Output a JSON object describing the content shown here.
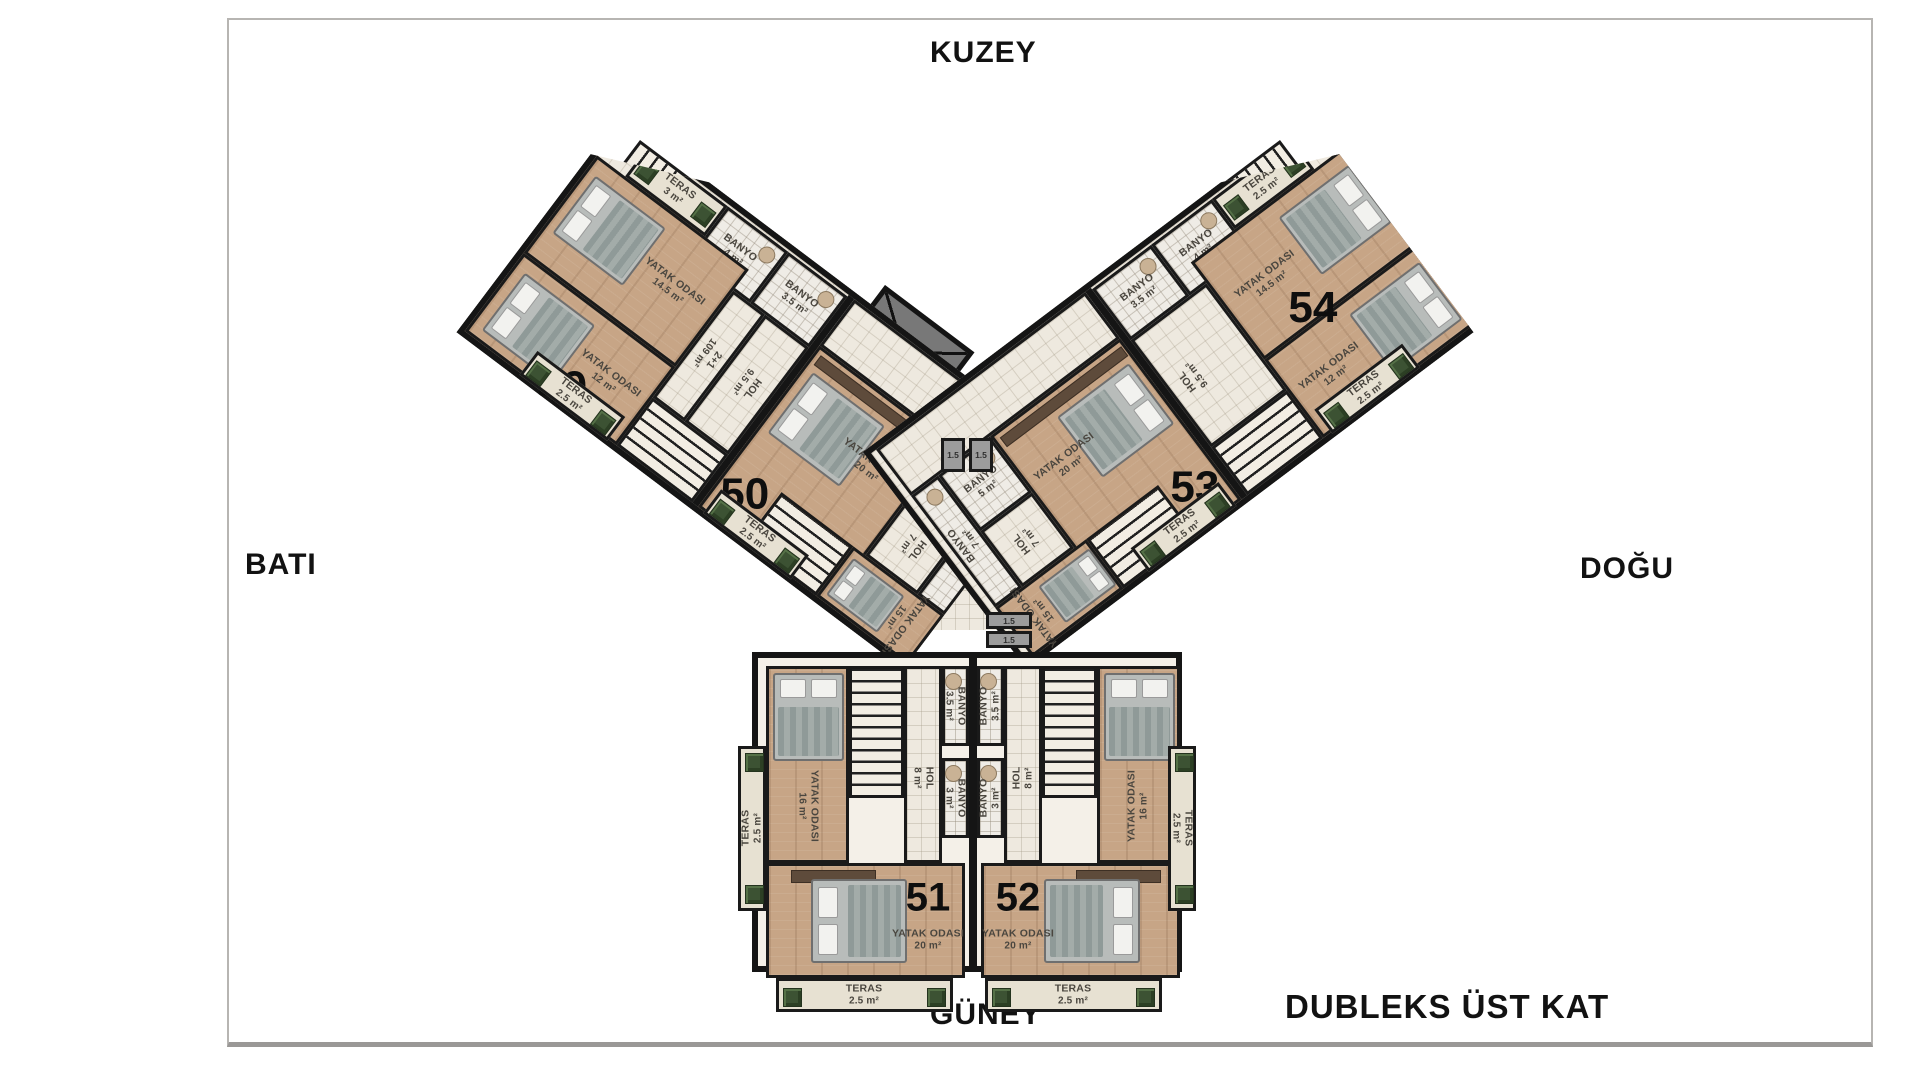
{
  "compass": {
    "north": "KUZEY",
    "south": "GÜNEY",
    "west": "BATI",
    "east": "DOĞU"
  },
  "floor_label": "DUBLEKS ÜST KAT",
  "core": {
    "shaft": "1.5",
    "stair_bath": "BANYO"
  },
  "colors": {
    "wall": "#1a1a1a",
    "wood": "#c7a586",
    "bath_tile": "#efece6",
    "terrace": "#e7e1d2",
    "plant": "#3c5233",
    "elevator": "#787878"
  },
  "units": {
    "u49": {
      "num": "49",
      "type": "2+1",
      "type_area": "109 m²",
      "bed1_n": "YATAK ODASI",
      "bed1_a": "14.5 m²",
      "bed2_n": "YATAK ODASI",
      "bed2_a": "12 m²",
      "bath1_n": "BANYO",
      "bath1_a": "4 m²",
      "bath2_n": "BANYO",
      "bath2_a": "3.5 m²",
      "hall_n": "HOL",
      "hall_a": "9.5 m²",
      "ter1_n": "TERAS",
      "ter1_a": "3 m²",
      "ter2_n": "TERAS",
      "ter2_a": "2.5 m²",
      "ter3_n": "TERAS",
      "ter3_a": "2.5 m²"
    },
    "u50": {
      "num": "50",
      "bed1_n": "YATAK ODASI",
      "bed1_a": "20 m²",
      "bed2_n": "YATAK ODASI",
      "bed2_a": "15 m²",
      "bath1_n": "BANYO",
      "bath1_a": "5 m²",
      "bath2_n": "BANYO",
      "bath2_a": "7 m²",
      "hall_n": "HOL",
      "hall_a": "7 m²",
      "ter1_n": "TERAS",
      "ter1_a": "2.5 m²",
      "ter2_n": "TERAS",
      "ter2_a": "2.5 m²"
    },
    "u51": {
      "num": "51",
      "bed1_n": "YATAK ODASI",
      "bed1_a": "20 m²",
      "bed2_n": "YATAK ODASI",
      "bed2_a": "16 m²",
      "bath1_n": "BANYO",
      "bath1_a": "3.5 m²",
      "bath2_n": "BANYO",
      "bath2_a": "3 m²",
      "hall_n": "HOL",
      "hall_a": "8 m²",
      "ter1_n": "TERAS",
      "ter1_a": "2.5 m²",
      "ter2_n": "TERAS",
      "ter2_a": "2.5 m²"
    },
    "u52": {
      "num": "52",
      "bed1_n": "YATAK ODASI",
      "bed1_a": "20 m²",
      "bed2_n": "YATAK ODASI",
      "bed2_a": "16 m²",
      "bath1_n": "BANYO",
      "bath1_a": "3.5 m²",
      "bath2_n": "BANYO",
      "bath2_a": "3 m²",
      "hall_n": "HOL",
      "hall_a": "8 m²",
      "ter1_n": "TERAS",
      "ter1_a": "2.5 m²",
      "ter2_n": "TERAS",
      "ter2_a": "2.5 m²"
    },
    "u53": {
      "num": "53",
      "bed1_n": "YATAK ODASI",
      "bed1_a": "20 m²",
      "bed2_n": "YATAK ODASI",
      "bed2_a": "15 m²",
      "bath1_n": "BANYO",
      "bath1_a": "5 m²",
      "bath2_n": "BANYO",
      "bath2_a": "7 m²",
      "hall_n": "HOL",
      "hall_a": "7 m²",
      "ter1_n": "TERAS",
      "ter1_a": "2.5 m²",
      "ter2_n": "TERAS",
      "ter2_a": "2.5 m²"
    },
    "u54": {
      "num": "54",
      "bed1_n": "YATAK ODASI",
      "bed1_a": "14.5 m²",
      "bed2_n": "YATAK ODASI",
      "bed2_a": "12 m²",
      "bath1_n": "BANYO",
      "bath1_a": "4 m²",
      "bath2_n": "BANYO",
      "bath2_a": "3.5 m²",
      "hall_n": "HOL",
      "hall_a": "9.5 m²",
      "ter1_n": "TERAS",
      "ter1_a": "2.5 m²",
      "ter2_n": "TERAS",
      "ter2_a": "2.5 m²"
    }
  }
}
